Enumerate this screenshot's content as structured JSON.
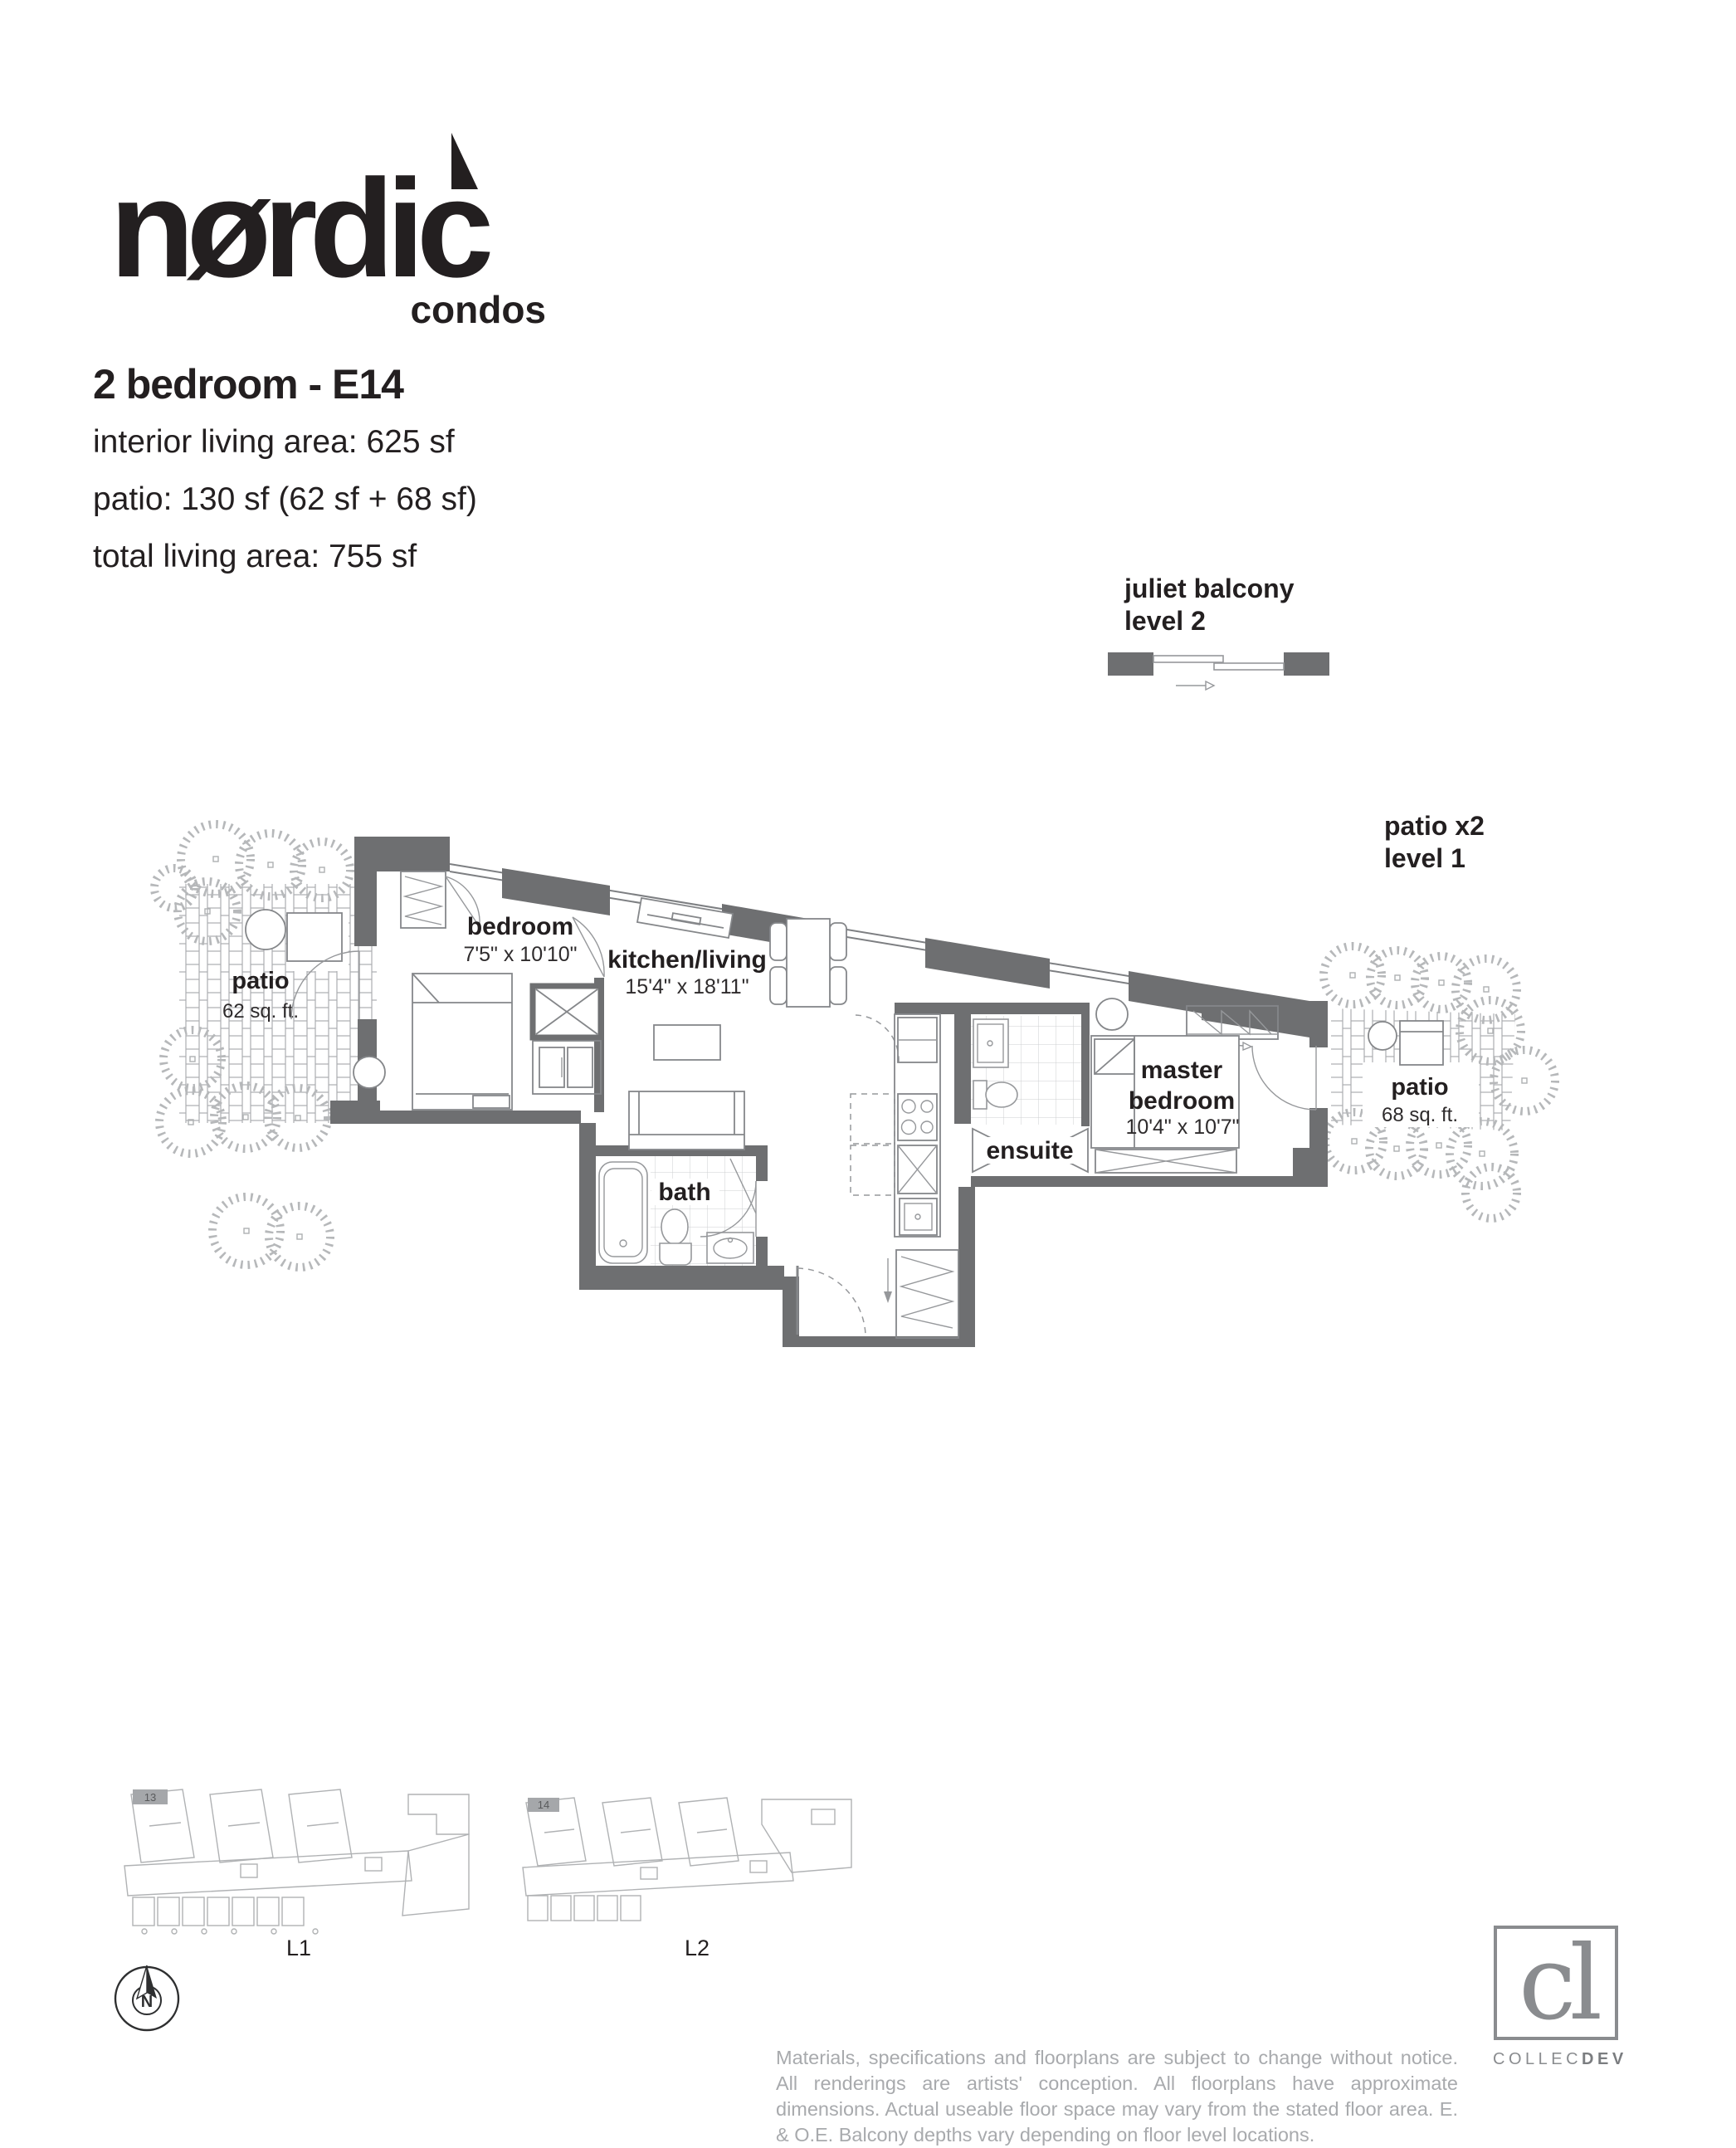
{
  "logo": {
    "brand": "nørdic",
    "sub": "condos"
  },
  "header": {
    "title": "2 bedroom - E14",
    "stats": [
      "interior living area: 625 sf",
      "patio: 130 sf (62 sf + 68 sf)",
      "total living area: 755 sf"
    ]
  },
  "callouts": {
    "juliet": {
      "line1": "juliet balcony",
      "line2": "level 2"
    },
    "patio": {
      "line1": "patio x2",
      "line2": "level 1"
    }
  },
  "rooms": {
    "patio_left": {
      "name": "patio",
      "area": "62 sq. ft."
    },
    "bedroom": {
      "name": "bedroom",
      "dims": "7'5\" x 10'10\""
    },
    "kitchen_living": {
      "name": "kitchen/living",
      "dims": "15'4\" x 18'11\""
    },
    "bath": {
      "name": "bath"
    },
    "ensuite": {
      "name": "ensuite"
    },
    "master": {
      "line1": "master",
      "line2": "bedroom",
      "dims": "10'4\" x 10'7\""
    },
    "patio_right": {
      "name": "patio",
      "area": "68 sq. ft."
    }
  },
  "keyplans": {
    "l1": {
      "label": "L1",
      "unit": "13"
    },
    "l2": {
      "label": "L2",
      "unit": "14"
    }
  },
  "compass": {
    "label": "N"
  },
  "footer": {
    "disclaimer": "Materials, specifications and floorplans are subject to change without notice. All renderings are artists' conception. All floorplans have approximate dimensions. Actual useable floor space may vary from the stated floor area. E. & O.E. Balcony depths vary depending on floor level locations.",
    "developer": {
      "monogram": "cl",
      "name_light": "COLLEC",
      "name_bold": "DEV"
    }
  }
}
